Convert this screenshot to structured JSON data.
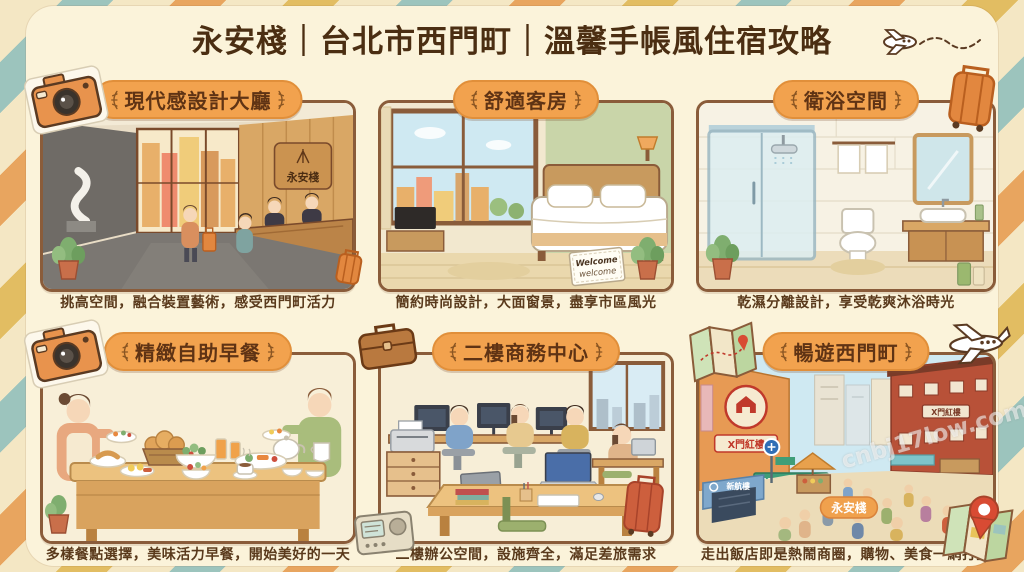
{
  "title": "永安棧｜台北市西門町｜溫馨手帳風住宿攻略",
  "panels": [
    {
      "header": "現代感設計大廳",
      "caption": "挑高空間，融合裝置藝術，感受西門町活力"
    },
    {
      "header": "舒適客房",
      "caption": "簡約時尚設計，大面窗景，盡享市區風光"
    },
    {
      "header": "衛浴空間",
      "caption": "乾濕分離設計，享受乾爽沐浴時光"
    },
    {
      "header": "精緻自助早餐",
      "caption": "多樣餐點選擇，美味活力早餐，開始美好的一天"
    },
    {
      "header": "二樓商務中心",
      "caption": "二樓辦公空間，設施齊全，滿足差旅需求"
    },
    {
      "header": "暢遊西門町",
      "caption": "走出飯店即是熱鬧商圈，購物、美食一網打盡"
    }
  ],
  "scene": {
    "lobby_sign": "永安棧",
    "welcome_line1": "Welcome",
    "welcome_line2": "welcome",
    "red_house_sign": "X門紅樓",
    "brick_building_sign": "X門紅樓",
    "street_banner": "XIMENO",
    "mrt_sign": "新航樓",
    "hotel_badge": "永安棧"
  },
  "watermark": "cnbj17low.com",
  "colors": {
    "badge": "#f2a24e",
    "title_text": "#4b2e12",
    "caption_text": "#5a3a1c",
    "panel_border": "#8a5c3a",
    "card_bg": "#fbf3da",
    "stripe_teal": "#9cc4bd",
    "stripe_orange": "#e8a55f",
    "stripe_mustard": "#e2bd62",
    "stripe_cream": "#f4e7c4"
  }
}
